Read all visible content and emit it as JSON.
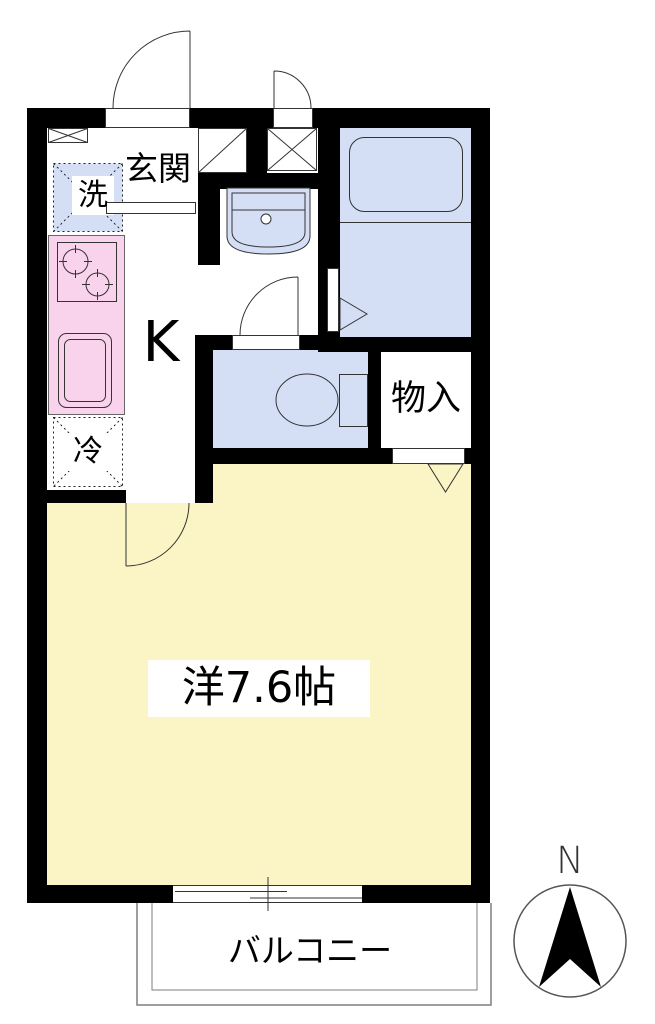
{
  "floorplan": {
    "labels": {
      "entrance": "玄関",
      "washer": "洗",
      "kitchen": "K",
      "fridge": "冷",
      "storage": "物入",
      "main_room": "洋7.6帖",
      "balcony": "バルコニー",
      "north": "N"
    },
    "colors": {
      "room_yellow": "#FBF5C6",
      "wet_area_blue": "#D4DFF6",
      "kitchen_pink": "#F9D3EC",
      "wall": "#000000",
      "balcony_line": "#7E7E7E"
    }
  }
}
